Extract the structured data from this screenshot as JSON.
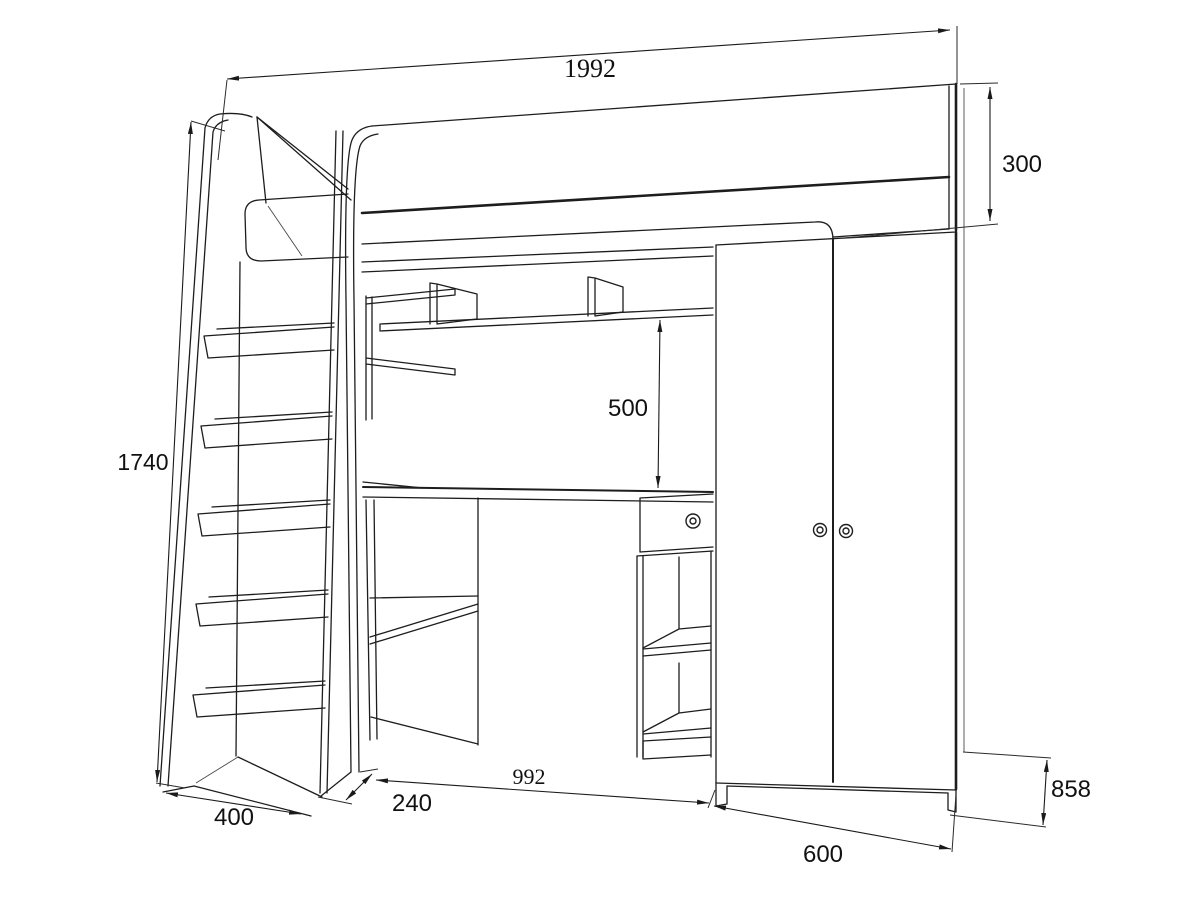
{
  "diagram": {
    "type": "furniture-dimension-drawing",
    "subject": "loft bed with ladder, desk, shelves and wardrobe (perspective line drawing)",
    "units_shown": "none (numeric labels only)",
    "colors": {
      "ink": "#1d1d1d",
      "background": "#ffffff",
      "label_text": "#111111"
    },
    "dimensions": {
      "overall_width": "1992",
      "guard_rail_height": "300",
      "overall_height": "1740",
      "shelf_to_desk_height": "500",
      "ladder_depth": "400",
      "ladder_offset": "240",
      "desk_width": "992",
      "wardrobe_width": "600",
      "wardrobe_side_depth": "858"
    }
  }
}
